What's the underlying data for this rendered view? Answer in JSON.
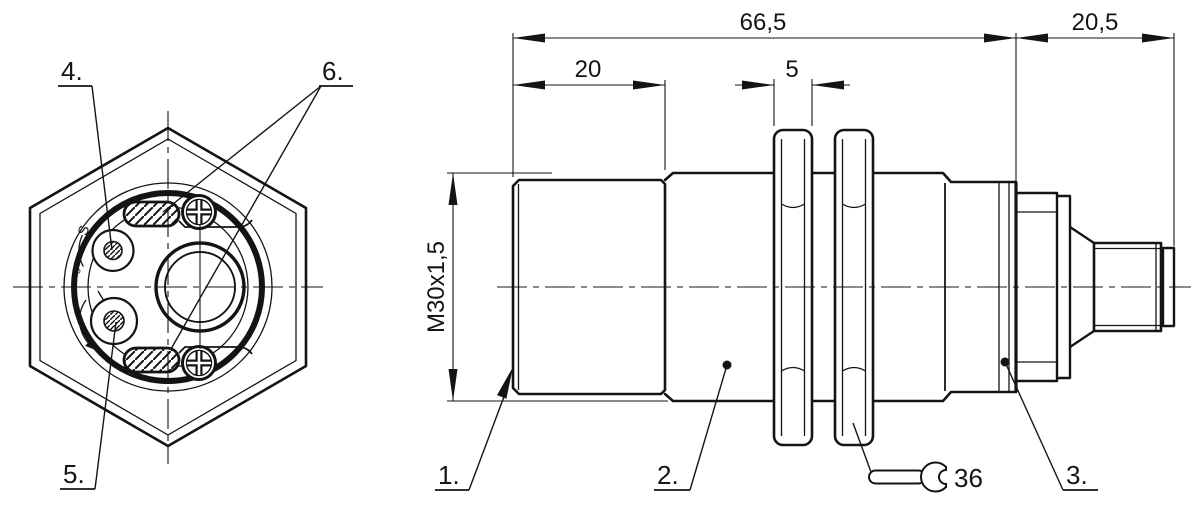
{
  "colors": {
    "background": "#ffffff",
    "line": "#141414"
  },
  "front_view": {
    "callout_top_pot": "4.",
    "callout_bottom_pot": "5.",
    "callout_slots": "6.",
    "pot_scale_max": "S",
    "pot_scale_min": "s"
  },
  "side_view": {
    "callout_sensing_face": "1.",
    "callout_housing": "2.",
    "callout_led_ring": "3.",
    "dim_overall_length": "66,5",
    "dim_connector_length": "20,5",
    "dim_head_length": "20",
    "dim_nut_thickness": "5",
    "thread_spec": "M30x1,5",
    "wrench_size": "36"
  }
}
